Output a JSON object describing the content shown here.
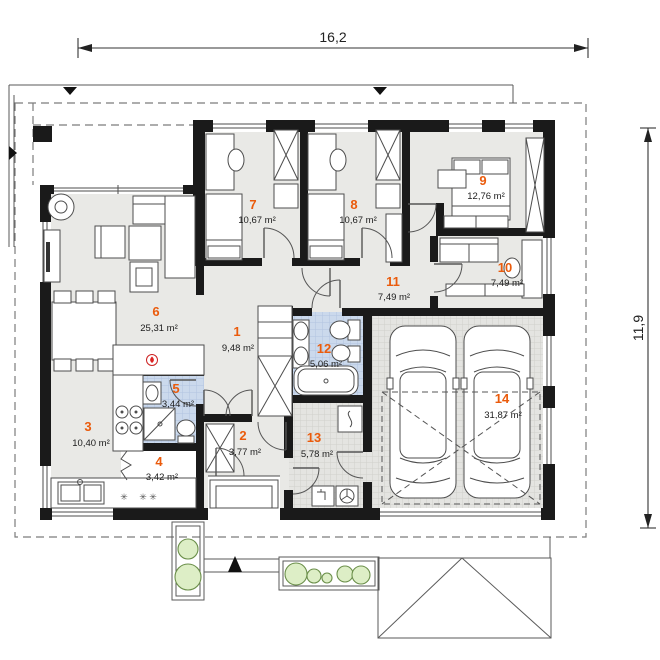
{
  "plan": {
    "title": "single-storey house floor plan",
    "width_label": "16,2",
    "height_label": "11,9",
    "accent_color": "#ea5b0c",
    "wall_color": "#1a1a1a",
    "floor_color": "#e9e9e6",
    "bath_floor_color": "#cbd9ec",
    "garage_floor_color": "#e4e4e1"
  },
  "rooms": [
    {
      "number": "1",
      "area": "9,48 m²"
    },
    {
      "number": "2",
      "area": "3,77 m²"
    },
    {
      "number": "3",
      "area": "10,40 m²"
    },
    {
      "number": "4",
      "area": "3,42 m²"
    },
    {
      "number": "5",
      "area": "3,44 m²"
    },
    {
      "number": "6",
      "area": "25,31 m²"
    },
    {
      "number": "7",
      "area": "10,67 m²"
    },
    {
      "number": "8",
      "area": "10,67 m²"
    },
    {
      "number": "9",
      "area": "12,76 m²"
    },
    {
      "number": "10",
      "area": "7,49 m²"
    },
    {
      "number": "11",
      "area": "7,49 m²"
    },
    {
      "number": "12",
      "area": "5,06 m²"
    },
    {
      "number": "13",
      "area": "5,78 m²"
    },
    {
      "number": "14",
      "area": "31,87 m²"
    }
  ],
  "symbols": {
    "floor_drains": "✳ ✳ ✳"
  }
}
